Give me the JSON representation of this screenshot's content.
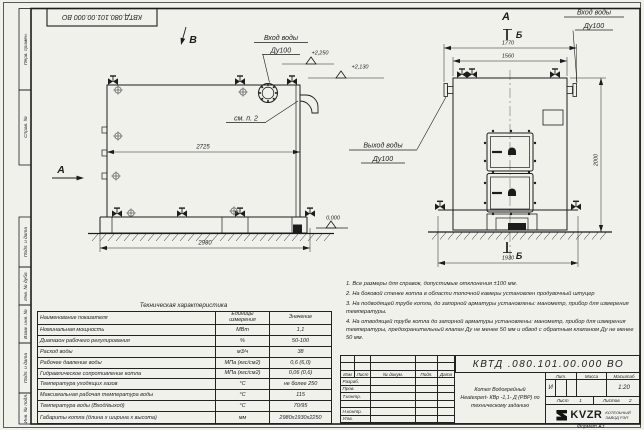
{
  "sheet": {
    "doc_number": "КВТД .080.101.00.000  ВО",
    "stamp": "КВТД.080.101.00.000 ВО",
    "format": "Формат  А3"
  },
  "margin": {
    "top": [
      "Перв. примен.",
      "Справ. №"
    ],
    "bottom": [
      "Подп. и дата",
      "Инв. № дубл.",
      "Взам. инв. №",
      "Подп. и дата",
      "Инв. № подл."
    ]
  },
  "drawing": {
    "side_view": {
      "view_letter_b": "В",
      "arrow_letter_a": "А",
      "dim_inner": "2725",
      "dim_total": "2980",
      "elev_1": "+2,250",
      "elev_2": "+2,130",
      "elev_zero": "0,000",
      "inlet_label": "Вход воды",
      "inlet_dn": "Ду100",
      "see_note": "см. п. 2"
    },
    "front_view": {
      "view_letter": "А",
      "section_letter_top": "Б",
      "section_letter_bottom": "Б",
      "dim_top_outer": "1770",
      "dim_top_inner": "1560",
      "dim_height": "2000",
      "dim_width": "1930",
      "inlet_label": "Вход воды",
      "inlet_dn": "Ду100",
      "outlet_label": "Выход воды",
      "outlet_dn": "Ду100"
    }
  },
  "notes": {
    "items": [
      "1. Все размеры для справок, допустимые отклонения ±100 мм.",
      "2. На боковой стенке котла в области топочной камеры установлен продувочный штуцер",
      "3. На подводящей трубе котла, до запорной арматуры установлены: манометр, прибор для измерения температуры.",
      "4. На отводящей трубе котла до запорной арматуры установлены: манометр, прибор для измерения температуры, предохранительный клапан Ду не менее 50 мм и обвод с обратным клапаном Ду не менее 50 мм."
    ]
  },
  "tech_table": {
    "title": "Техническая характеристика",
    "headers": [
      "Наименование показателя",
      "Единицы измерения",
      "Значение"
    ],
    "rows": [
      [
        "Номинальная мощность",
        "МВт",
        "1,1"
      ],
      [
        "Диапазон рабочего регулирования",
        "%",
        "50-100"
      ],
      [
        "Расход воды",
        "м3/ч",
        "38"
      ],
      [
        "Рабочее давление воды",
        "МПа (кгс/см2)",
        "0,6 (6,0)"
      ],
      [
        "Гидравлическое сопротивление котла",
        "МПа (кгс/см2)",
        "0,06 (0,6)"
      ],
      [
        "Температура уходящих газов",
        "°С",
        "не более 250"
      ],
      [
        "Максимальная рабочая температура воды",
        "°С",
        "115"
      ],
      [
        "Температура воды (Вход/выход)",
        "°С",
        "70/95"
      ],
      [
        "Габариты котла (длина х ширина х высота)",
        "мм",
        "2980х1930х2250"
      ]
    ]
  },
  "title_block": {
    "header_cells": [
      "Изм",
      "Лист",
      "№ докум.",
      "Подп.",
      "Дата"
    ],
    "row_labels": [
      "Разраб.",
      "Пров.",
      "Т.контр.",
      "",
      "Н.контр.",
      "Утв."
    ],
    "name_lines": [
      "Котел Водогрейный",
      "Heatexpert- КВр -1,1- Д (РВР)  по",
      "техническому заданию"
    ],
    "lit_label": "Лит.",
    "mass_label": "Масса",
    "scale_label": "Масштаб",
    "lit_value": "И",
    "scale_value": "1:20",
    "sheet_label": "Лист",
    "sheet_value": "1",
    "sheets_label": "Листов",
    "sheets_value": "2",
    "org_logo": "KVZR",
    "org_line1": "КОТЕЛЬНЫЙ",
    "org_line2": "ЗАВОД РЭП"
  }
}
